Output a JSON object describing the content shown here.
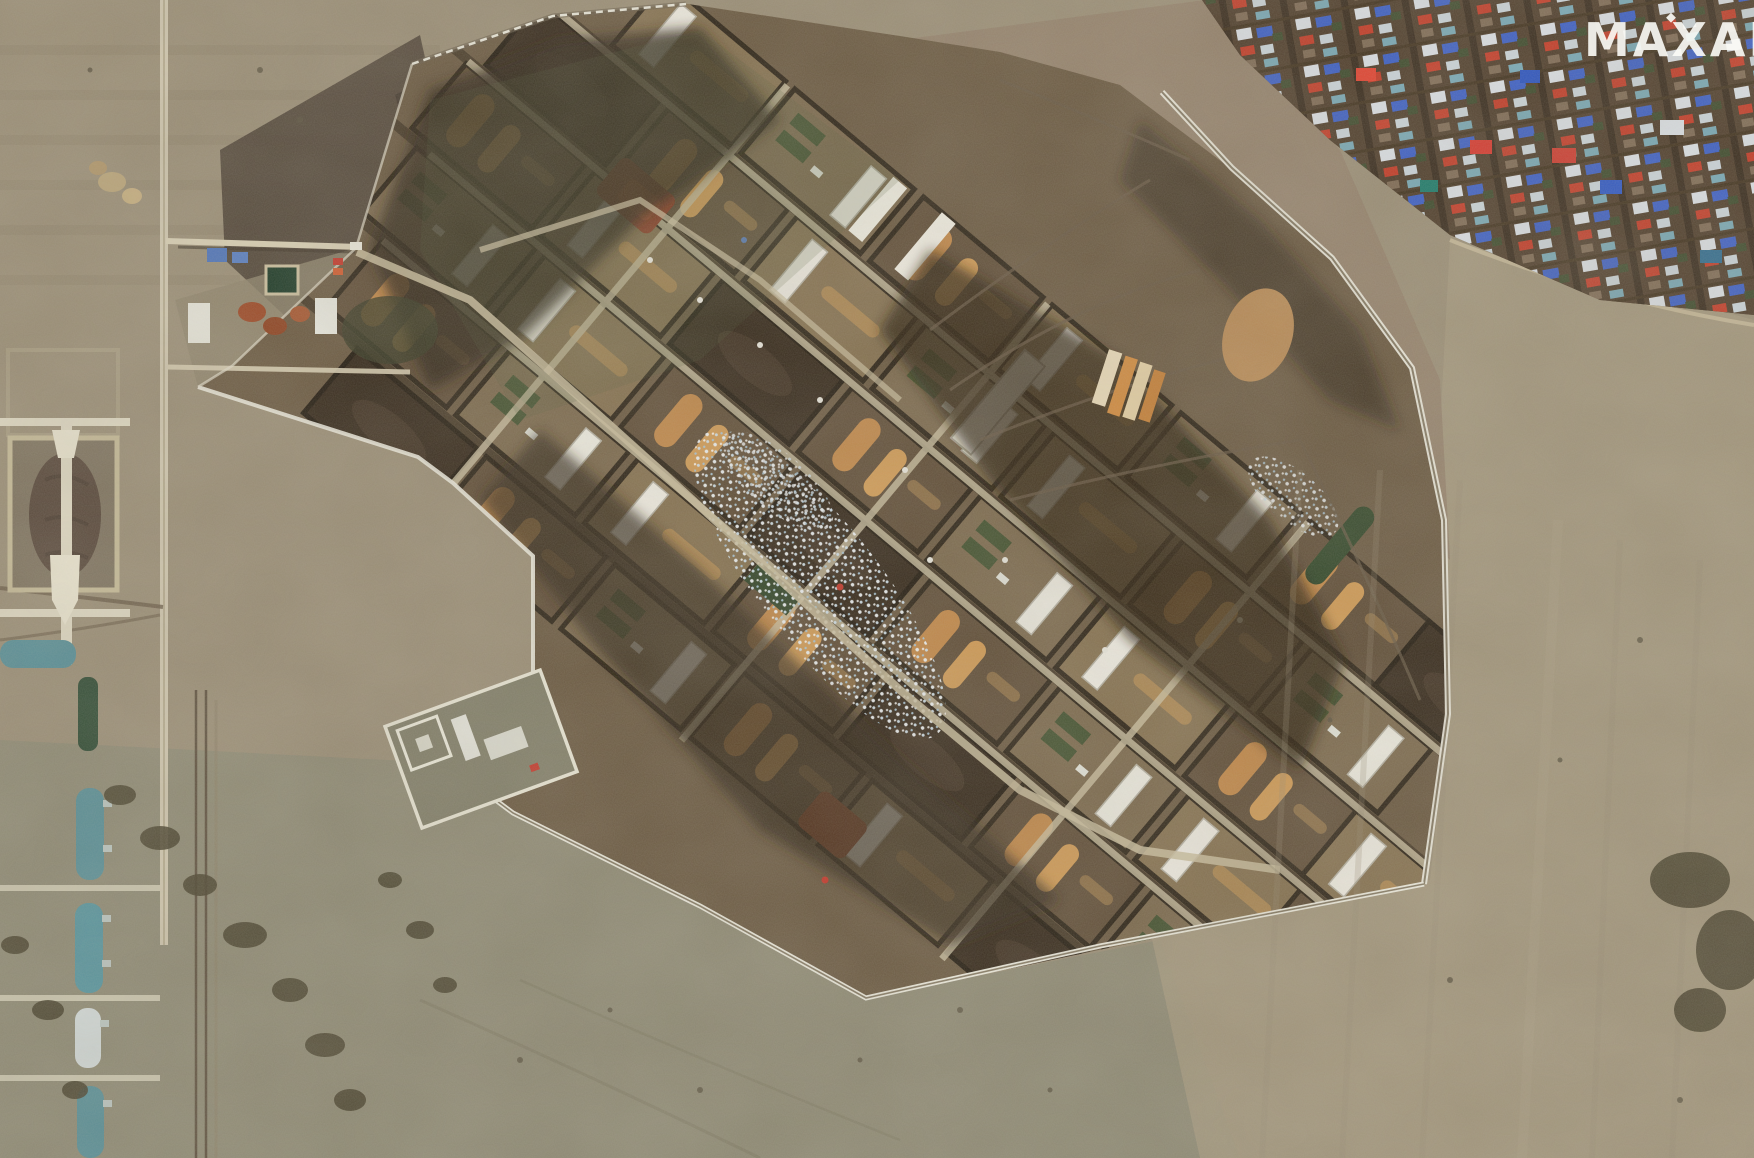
{
  "watermark": {
    "label": "MAXAR"
  },
  "scene": {
    "type": "satellite photograph",
    "description": "Overhead Maxar satellite view of a large fortified military storage depot: diagonal rows of earthen revetments with long white warehouse buildings, orange dirt piles, dark burn scars and a field of scattered white debris; a white perimeter fence surrounds the depot. A dense village with blue, red and white rooftops sits at top right, a column of teal arched storage hangars and a walled revetment yard lie along the left edge, and mottled brown farm fields with tracks and shrub lines fill the rest.",
    "regions": [
      {
        "id": "depot-compound",
        "label": "Fortified depot with bermed revetment rows"
      },
      {
        "id": "debris-field",
        "label": "Scattered white and blue debris"
      },
      {
        "id": "burn-scars",
        "label": "Charred dark ground bands"
      },
      {
        "id": "perimeter-fence",
        "label": "White perimeter fence"
      },
      {
        "id": "village",
        "label": "Village with blue, red and white rooftops"
      },
      {
        "id": "storage-hangars",
        "label": "Teal arched storage hangars"
      },
      {
        "id": "revetment-yard",
        "label": "Bermed yard with cross paths"
      },
      {
        "id": "walled-facility",
        "label": "Small white-walled facility"
      },
      {
        "id": "admin-area",
        "label": "Gate and administrative buildings"
      },
      {
        "id": "fields",
        "label": "Open agricultural fields with vehicle tracks"
      }
    ]
  },
  "palette": {
    "field_tan": "#9a8e76",
    "field_green_grey": "#8b8872",
    "field_right": "#a3987e",
    "field_pink_brown": "#93816b",
    "plowed_dark": "#473b2d",
    "depot_base": "#6a5941",
    "berm_dark": "#2c2316",
    "charred": "#2b2114",
    "cell_tan": "#84704f",
    "road_light": "#cfc3a4",
    "fence_white": "#e9e7da",
    "building_white": "#ece9df",
    "pile_orange": "#c08748",
    "equipment_green": "#41502e",
    "hangar_teal": "#578e96",
    "village_ground": "#4e3d2b",
    "roof_blue": "#3b5ec4",
    "roof_red": "#c23b27",
    "roof_white": "#d9dee3",
    "rust_debris": "#9c4a28"
  }
}
